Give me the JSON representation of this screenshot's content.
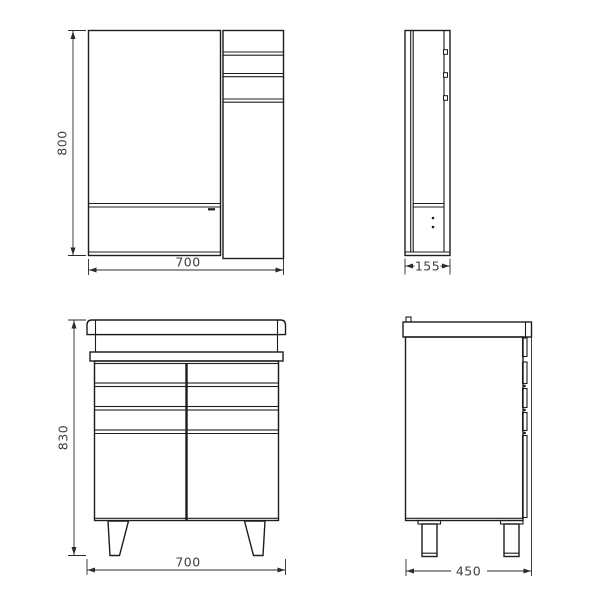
{
  "colors": {
    "background": "#ffffff",
    "line": "#1d1d1b",
    "dimension_line": "#2b2b2b",
    "dimension_text": "#3f3f3f"
  },
  "dimensions": {
    "mirror_height": "800",
    "mirror_width": "700",
    "mirror_depth": "155",
    "vanity_height": "830",
    "vanity_width": "700",
    "vanity_depth": "450"
  }
}
